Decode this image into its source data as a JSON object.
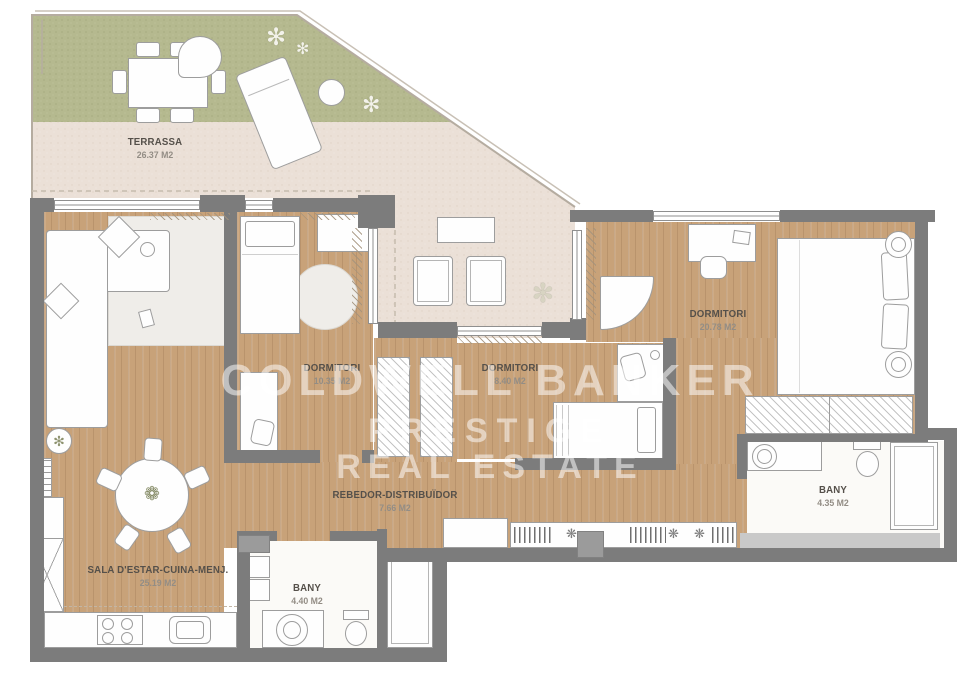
{
  "watermark": {
    "brand": "COLDWELL BANKER",
    "sub1": "PRESTIGE",
    "sub2": "REAL ESTATE"
  },
  "rooms": [
    {
      "name": "TERRASSA",
      "area": "26.37 M2"
    },
    {
      "name": "DORMITORI",
      "area": "10.35 M2"
    },
    {
      "name": "DORMITORI",
      "area": "8.40 M2"
    },
    {
      "name": "DORMITORI",
      "area": "20.78 M2"
    },
    {
      "name": "REBEDOR-DISTRIBUÏDOR",
      "area": "7.66 M2"
    },
    {
      "name": "SALA D'ESTAR-CUINA-MENJ.",
      "area": "25.19 M2"
    },
    {
      "name": "BANY",
      "area": "4.40 M2"
    },
    {
      "name": "BANY",
      "area": "4.35 M2"
    }
  ],
  "icons": {
    "plant": "✻",
    "dining_centerpiece": "❁",
    "shelf_flower": "❋"
  },
  "colors": {
    "grass": "#b5b98f",
    "paving": "#ebe0d7",
    "wood": "#c8a279",
    "wall": "#7c7c7c",
    "watermark": "#ffffff"
  }
}
